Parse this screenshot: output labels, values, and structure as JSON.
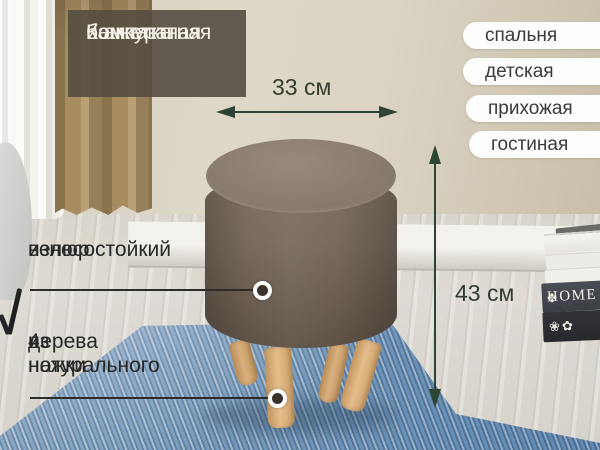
{
  "header": {
    "lines": [
      "Компактная",
      "и аккуратная",
      "банкетка"
    ]
  },
  "rooms": [
    "спальня",
    "детская",
    "прихожая",
    "гостиная"
  ],
  "dimensions": {
    "width": "33 см",
    "height": "43 см"
  },
  "callouts": {
    "material": [
      "износостойкий",
      "велюр"
    ],
    "legs": [
      "4 ножки",
      "из натурального",
      "дерева"
    ]
  },
  "props": {
    "book_spine": "HOME",
    "book_ornament": "✤",
    "book_floral": "❀✿"
  },
  "colors": {
    "arrow_green": "#2c4434",
    "header_bg": "#554c40",
    "header_text": "#f6f2e9",
    "pill_bg": "#ffffff",
    "pill_text": "#3a3a3a",
    "callout_text": "#272727",
    "ottoman_fabric": "#77695b",
    "leg_wood": "#d9ae7c",
    "rug_blue": "#7b9cbb",
    "wall_beige": "#d6cfbf"
  }
}
